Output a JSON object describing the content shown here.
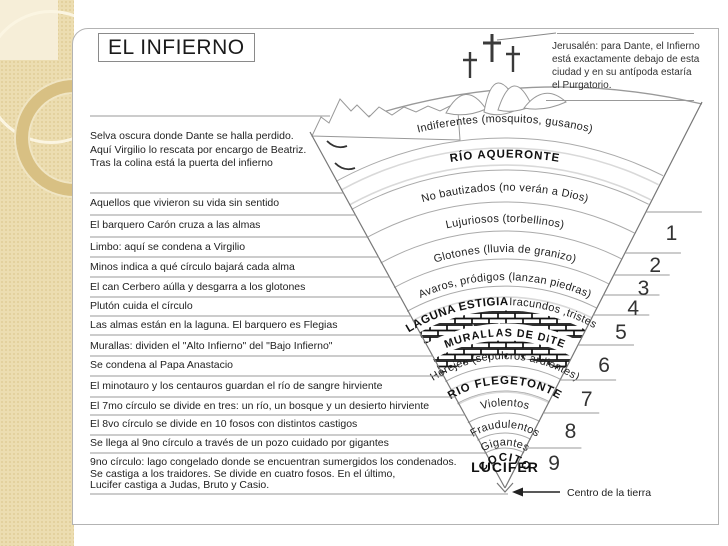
{
  "slide": {
    "title": "EL INFIERNO",
    "jerusalem_note": "Jerusalén: para Dante, el Infierno\nestá exactamente debajo de esta\nciudad y en su antípoda estaría\nel Purgatorio.",
    "intro_note": "Selva oscura donde Dante se halla perdido.\nAquí Virgilio lo rescata por encargo de Beatriz.\nTras la colina está la puerta del infierno",
    "notes": [
      "Aquellos que vivieron su vida sin sentido",
      "El barquero Carón cruza a las almas",
      "Limbo: aquí se condena a Virgilio",
      "Minos indica a qué círculo bajará cada alma",
      "El can Cerbero aúlla y desgarra a los glotones",
      "Plutón cuida el círculo",
      "Las almas están en la laguna. El barquero es Flegias",
      "Murallas: dividen el \"Alto Infierno\" del \"Bajo Infierno\"",
      "Se condena al Papa Anastacio",
      "El minotauro y los centauros guardan el río de sangre hirviente",
      "El 7mo círculo se divide en tres: un río, un bosque y un desierto hirviente",
      "El 8vo círculo se divide en 10 fosos con distintos castigos",
      "Se llega al 9no círculo a través de un pozo cuidado por gigantes",
      "9no círculo: lago congelado donde se encuentran sumergidos los condenados.\nSe castiga a los traidores. Se divide en cuatro fosos. En el último,\nLucifer castiga a Judas, Bruto y Casio."
    ],
    "funnel": {
      "bands": [
        {
          "label": "Indiferentes (mosquitos, gusanos)",
          "style": "regular"
        },
        {
          "label": "RÍO AQUERONTE",
          "style": "river"
        },
        {
          "label": "No bautizados (no verán a Dios)",
          "style": "regular"
        },
        {
          "label": "Lujuriosos (torbellinos)",
          "style": "regular"
        },
        {
          "label": "Glotones (lluvia de granizo)",
          "style": "regular"
        },
        {
          "label": "Avaros, pródigos (lanzan piedras)",
          "style": "regular"
        },
        {
          "label": "LAGUNA ESTIGIA",
          "label2": "Iracundos ,tristes",
          "style": "lake"
        },
        {
          "label": "MURALLAS DE DITE",
          "style": "wall"
        },
        {
          "label": "Herejes (sepulcros ardientes)",
          "style": "regular"
        },
        {
          "label": "RIO FLEGETONTE",
          "style": "river"
        },
        {
          "label": "Violentos",
          "style": "regular"
        },
        {
          "label": "Fraudulentos",
          "style": "regular"
        },
        {
          "label": "Gigantes",
          "style": "regular"
        },
        {
          "label": "COCITO",
          "style": "river"
        },
        {
          "label": "LUCIFER",
          "style": "lucifer"
        }
      ],
      "circle_numbers": [
        "1",
        "2",
        "3",
        "4",
        "5",
        "6",
        "7",
        "8",
        "9"
      ],
      "center_of_earth_label": "Centro de la tierra"
    },
    "theme": {
      "sidebar_beige": "#ecddb1",
      "line_gray": "#999999",
      "ink": "#222222"
    }
  }
}
